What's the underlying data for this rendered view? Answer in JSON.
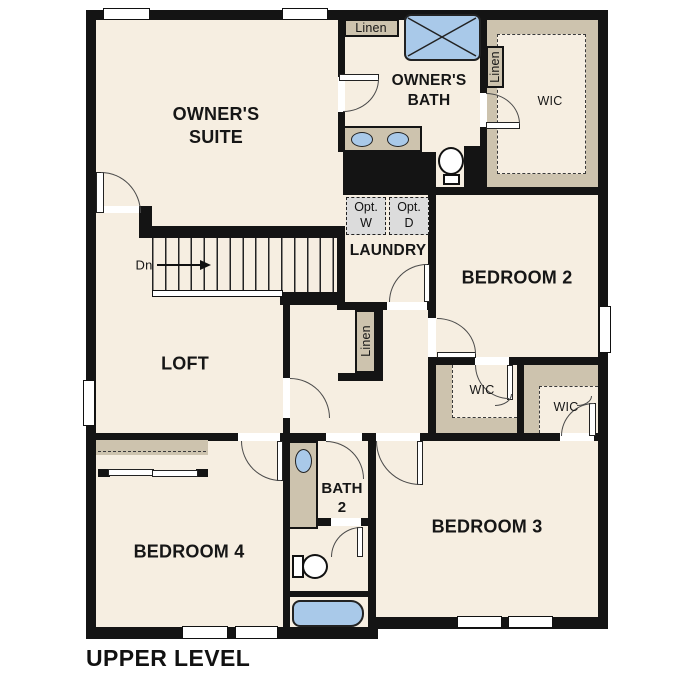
{
  "title": "UPPER LEVEL",
  "colors": {
    "floor": "#f6eee1",
    "closet": "#cdc3ae",
    "wall": "#141414",
    "fixture": "#a9c9e9",
    "optional": "#dcdcdc"
  },
  "rooms": {
    "owners_suite": "OWNER'S\nSUITE",
    "owners_bath": "OWNER'S\nBATH",
    "loft": "LOFT",
    "laundry": "LAUNDRY",
    "bedroom2": "BEDROOM 2",
    "bedroom3": "BEDROOM 3",
    "bedroom4": "BEDROOM 4",
    "bath2": "BATH\n2"
  },
  "closets": {
    "linen_top": "Linen",
    "linen_bath": "Linen",
    "linen_hall": "Linen",
    "wic_owners": "WIC",
    "wic_bedroom2": "WIC",
    "wic_bedroom3": "WIC"
  },
  "laundry_options": {
    "washer": "Opt.\nW",
    "dryer": "Opt.\nD"
  },
  "stairs": {
    "direction_label": "Dn"
  }
}
